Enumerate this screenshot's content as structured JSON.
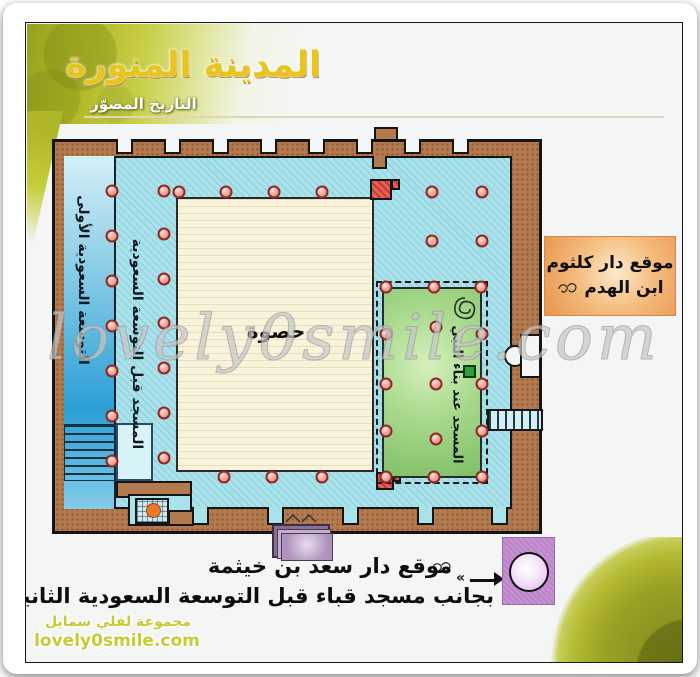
{
  "header": {
    "brand_title": "المدينة المنورة",
    "brand_subtitle": "التاريخ المصوّر"
  },
  "watermark": "lovely0smile.com",
  "plan": {
    "labels": {
      "expansion_first": "التوسعة السعودية الأولى",
      "before_expansion": "المسجد قبل التوسعة السعودية",
      "courtyard": "حصوة",
      "prophet_mosque": "المسجد عند بناء النبي",
      "prophet_honorific": "ﷺ"
    },
    "column_positions": [
      [
        86,
        168
      ],
      [
        86,
        213
      ],
      [
        86,
        258
      ],
      [
        86,
        303
      ],
      [
        86,
        348
      ],
      [
        86,
        393
      ],
      [
        86,
        438
      ],
      [
        138,
        168
      ],
      [
        138,
        211
      ],
      [
        138,
        256
      ],
      [
        138,
        300
      ],
      [
        138,
        345
      ],
      [
        138,
        390
      ],
      [
        138,
        435
      ],
      [
        153,
        169
      ],
      [
        200,
        169
      ],
      [
        248,
        169
      ],
      [
        296,
        169
      ],
      [
        198,
        454
      ],
      [
        246,
        454
      ],
      [
        296,
        454
      ],
      [
        406,
        169
      ],
      [
        456,
        169
      ],
      [
        406,
        218
      ],
      [
        456,
        218
      ],
      [
        360,
        264
      ],
      [
        408,
        264
      ],
      [
        455,
        264
      ],
      [
        360,
        311
      ],
      [
        360,
        361
      ],
      [
        360,
        408
      ],
      [
        360,
        454
      ],
      [
        456,
        311
      ],
      [
        456,
        361
      ],
      [
        456,
        408
      ],
      [
        408,
        454
      ],
      [
        456,
        454
      ],
      [
        410,
        304
      ],
      [
        410,
        361
      ],
      [
        410,
        416
      ]
    ]
  },
  "callouts": {
    "kulthum": {
      "line1": "موقع دار كلثوم",
      "line2": "ابن الهدم",
      "honorific": "رضي الله عنه"
    },
    "saad": {
      "line1": "موقع دار سعد بن خيثمة",
      "honorific": "رضي الله عنه",
      "line2": "بجانب مسجد قباء قبل التوسعة السعودية الثانية",
      "arrow_mark": "«"
    }
  },
  "credits": {
    "group": "مجموعة لفلي سمايل",
    "site": "lovely0smile.com"
  },
  "colors": {
    "wall_brown": "#b3794f",
    "interior_cyan": "#aae2ec",
    "expansion_blue": "#2b9fd6",
    "courtyard_cream": "#f8f3da",
    "mosque_green": "#a8d98c",
    "callout_orange": "#f4bd80",
    "marker_purple": "#c490d2",
    "column_pink": "#f2a09a",
    "olive_brand": "#b4bb2a",
    "calligraphy_gold": "#e8c41e"
  }
}
